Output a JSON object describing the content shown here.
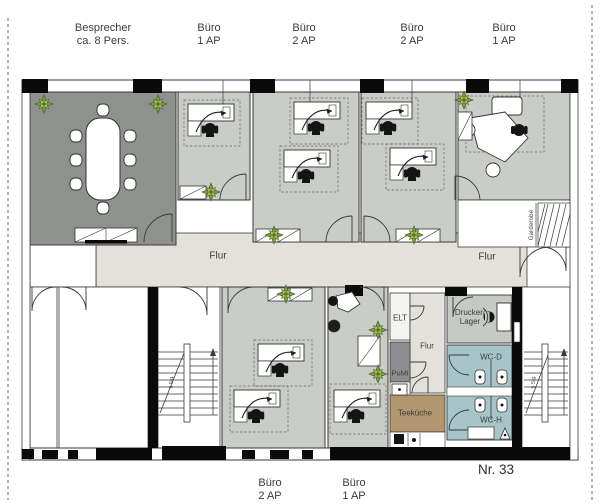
{
  "title_labels": {
    "top": [
      {
        "line1": "Besprecher",
        "line2": "ca. 8 Pers."
      },
      {
        "line1": "Büro",
        "line2": "1 AP"
      },
      {
        "line1": "Büro",
        "line2": "2 AP"
      },
      {
        "line1": "Büro",
        "line2": "2 AP"
      },
      {
        "line1": "Büro",
        "line2": "1 AP"
      }
    ],
    "bottom": [
      {
        "line1": "Büro",
        "line2": "2 AP"
      },
      {
        "line1": "Büro",
        "line2": "1 AP"
      }
    ]
  },
  "room_labels": {
    "flur_main": "Flur",
    "flur_right": "Flur",
    "flur_small": "Flur",
    "elt": "ELT",
    "pumi": "PuMi",
    "teekueche": "Teeküche",
    "wc_d": "WC-D",
    "wc_h": "WC-H",
    "drucker_line1": "Drucker/",
    "drucker_line2": "Lager",
    "garderobe": "Garderobe"
  },
  "plan_number": "Nr. 33",
  "stair_note": "9 Stg.",
  "colors": {
    "office_floor": "#c9ccc7",
    "meeting_floor": "#8e918e",
    "corridor_floor": "#e3e2da",
    "wc_floor": "#a7c4c8",
    "teekueche_floor": "#b2966e",
    "pumi_floor": "#8e8e90",
    "wall_black": "#0a0a0a",
    "plant_green": "#7d9c42"
  }
}
